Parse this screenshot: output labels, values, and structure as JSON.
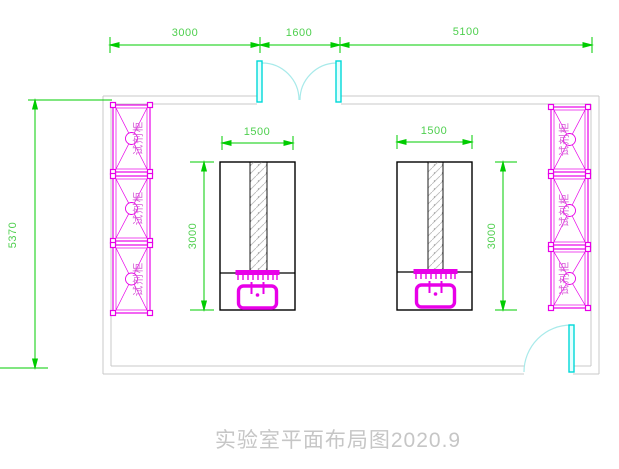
{
  "title": {
    "text": "实验室平面布局图2020.9"
  },
  "dims": {
    "top_left": "3000",
    "top_middle": "1600",
    "top_right": "5100",
    "overall_height": "5370",
    "bench_width": "1500",
    "bench_depth": "3000"
  },
  "labels": {
    "reagent_cabinet": "试剂柜"
  },
  "colors": {
    "dimension": "#00cc00",
    "cabinet": "#e800e8",
    "door_leaf": "#00d8d8",
    "door_arc": "#a8eaea",
    "wall": "#c8c8c8",
    "bench_outline": "#000000",
    "title": "#c6c6c6"
  }
}
